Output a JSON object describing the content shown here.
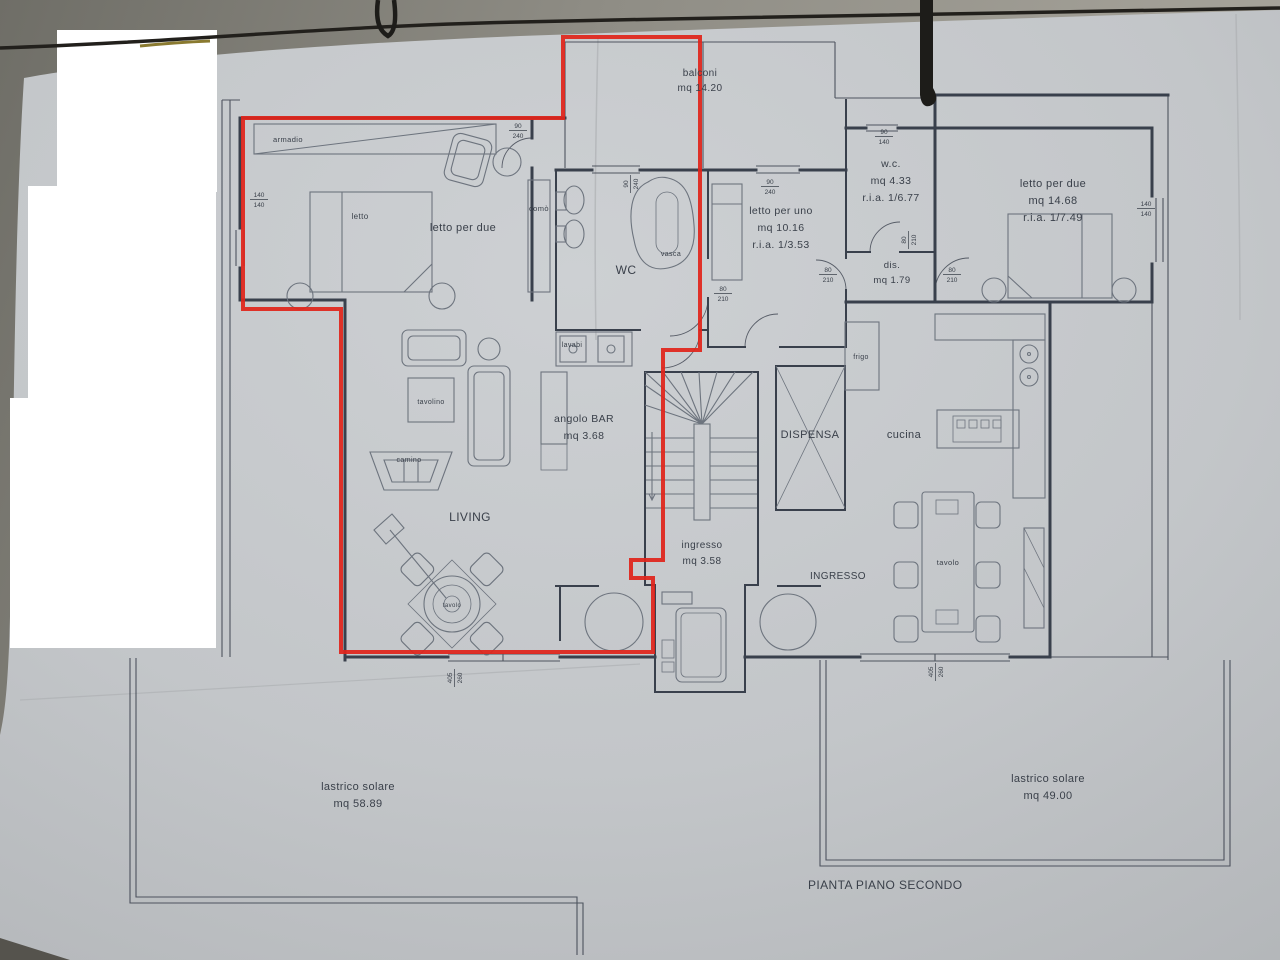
{
  "plan": {
    "title": "PIANTA PIANO SECONDO",
    "balcony": {
      "label": "balconi",
      "area": "mq 14.20"
    },
    "bedroom_left": {
      "label": "letto per due",
      "bed": "letto",
      "wardrobe": "armadio",
      "dresser": "comò"
    },
    "bathroom": {
      "label": "WC",
      "tub": "vasca",
      "sinks": "lavabi"
    },
    "bedroom_single": {
      "label": "letto per uno",
      "area": "mq 10.16",
      "ria": "r.i.a. 1/3.53"
    },
    "wc_small": {
      "label": "w.c.",
      "area": "mq 4.33",
      "ria": "r.i.a. 1/6.77"
    },
    "dis": {
      "label": "dis.",
      "area": "mq 1.79"
    },
    "bedroom_right": {
      "label": "letto per due",
      "area": "mq 14.68",
      "ria": "r.i.a. 1/7.49"
    },
    "bar": {
      "label": "angolo BAR",
      "area": "mq 3.68"
    },
    "living": {
      "label": "LIVING",
      "coffee_table": "tavolino",
      "fireplace": "camino",
      "round_table": "tavolo"
    },
    "pantry": {
      "label": "DISPENSA"
    },
    "kitchen": {
      "label": "cucina",
      "fridge": "frigo",
      "table": "tavolo"
    },
    "entry": {
      "label": "ingresso",
      "area": "mq 3.58"
    },
    "hall": {
      "label": "INGRESSO"
    },
    "terrace_left": {
      "label": "lastrico solare",
      "area": "mq 58.89"
    },
    "terrace_right": {
      "label": "lastrico solare",
      "area": "mq 49.00"
    },
    "dims": {
      "n140": "140",
      "n80": "80",
      "n210": "210",
      "n90": "90",
      "n240": "240",
      "n405": "405",
      "n260": "260"
    }
  },
  "colors": {
    "paper": "#c6c9cb",
    "wall": "#39404c",
    "furniture": "#6d747e",
    "red": "#e0251b",
    "ink": "#3a404a",
    "bg": "#8d8b83"
  }
}
